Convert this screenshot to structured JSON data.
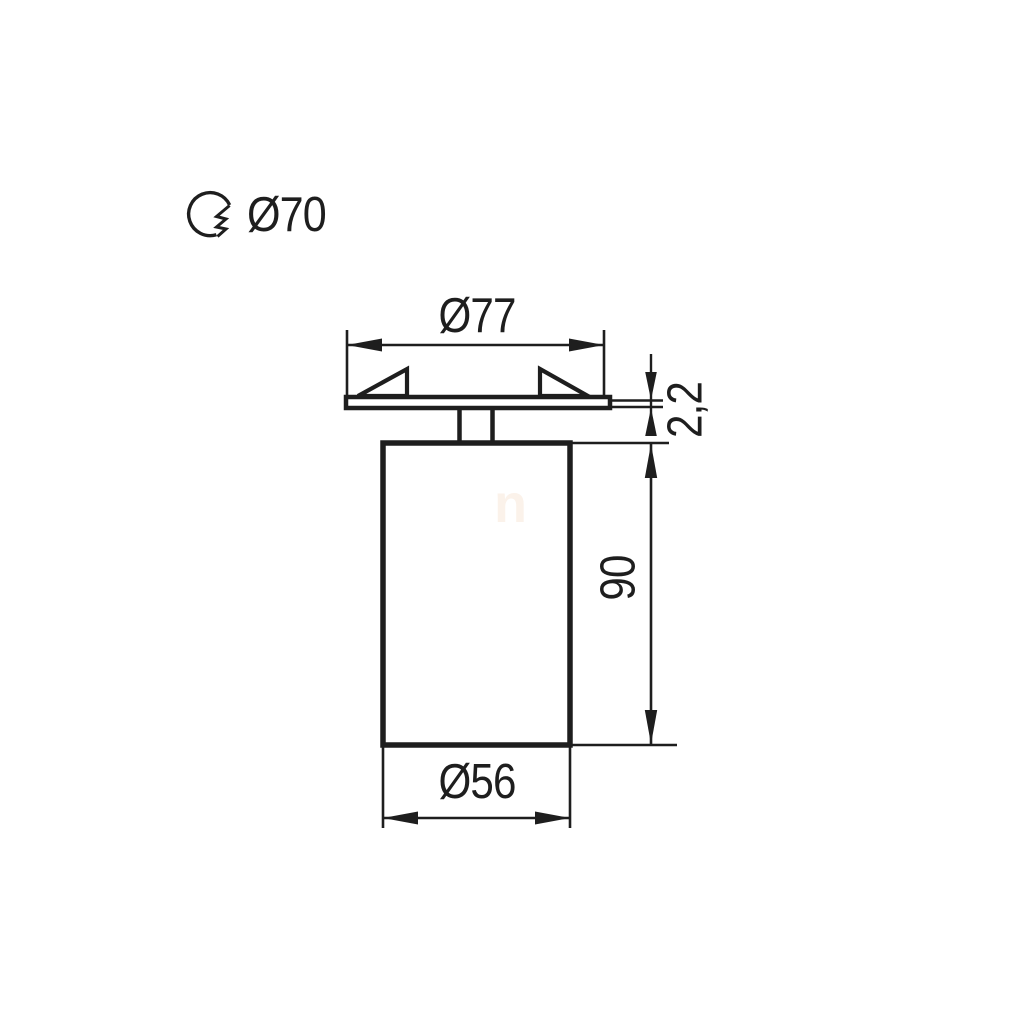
{
  "drawing": {
    "kind": "technical-dimension-drawing",
    "background_color": "#ffffff",
    "line_color": "#1e1e1e"
  },
  "cutout": {
    "icon": "cutout-hole-icon",
    "label": "Ø70"
  },
  "dimensions": {
    "flange_diameter": "Ø77",
    "flange_thickness": "2,2",
    "body_height": "90",
    "body_diameter": "Ø56"
  },
  "watermark": {
    "text": "n",
    "color": "#fbf2ea"
  }
}
